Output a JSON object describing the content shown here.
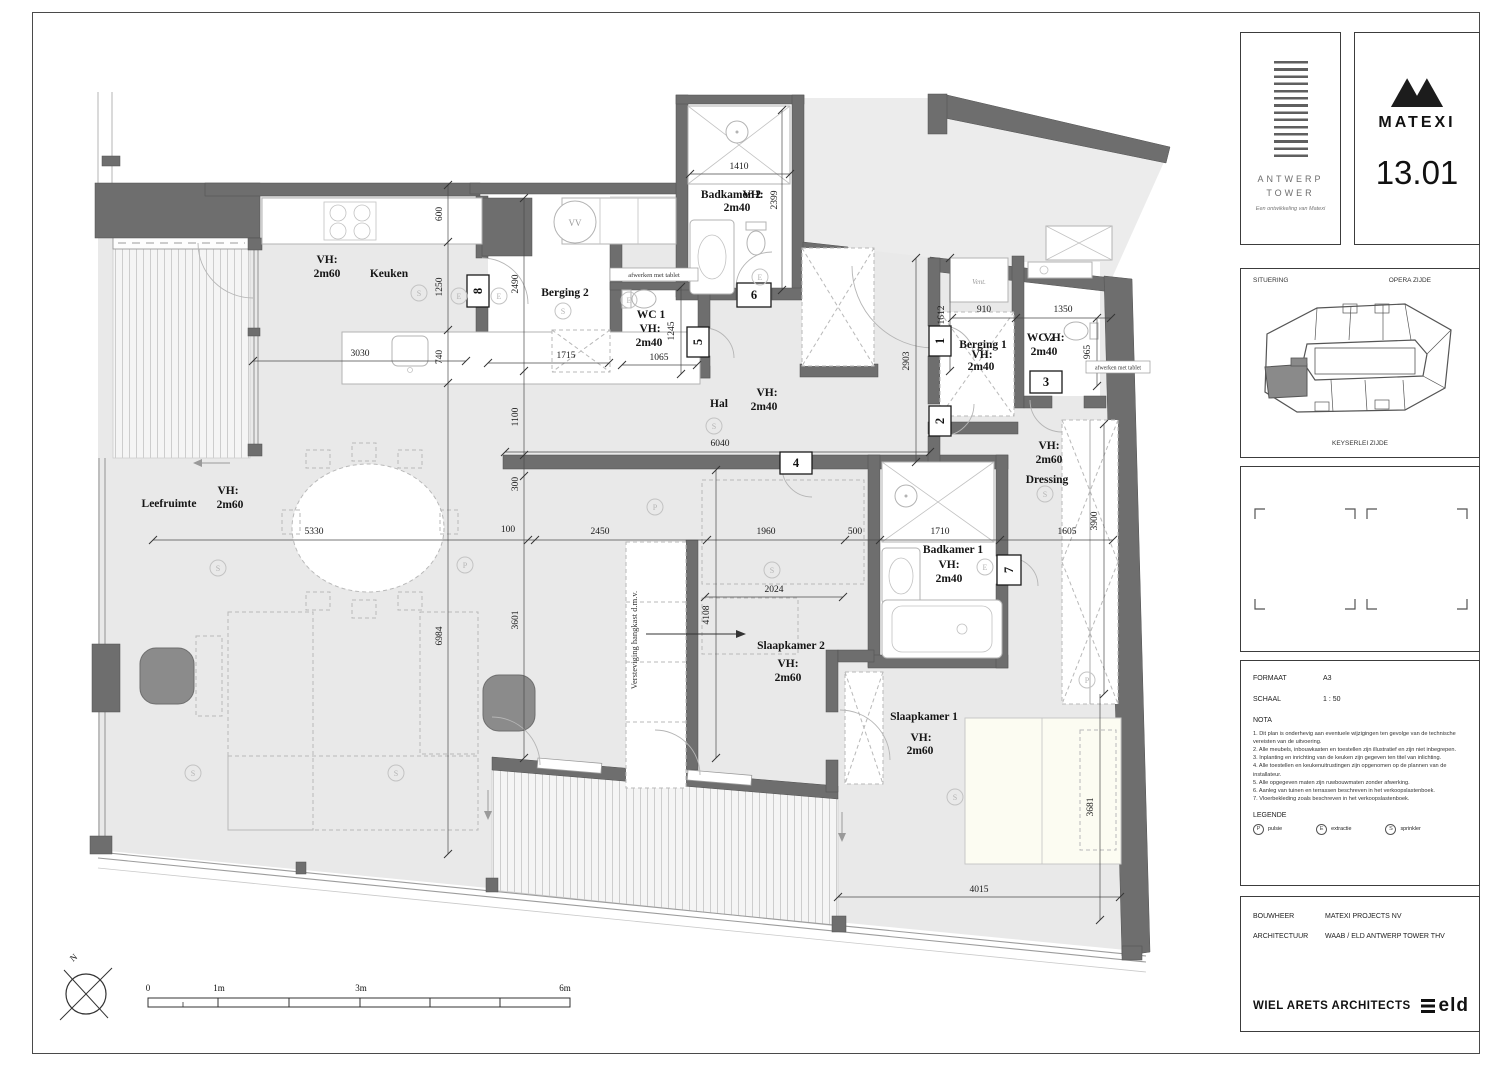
{
  "sheet": {
    "panels": {
      "antwerp": {
        "title_line1": "ANTWERP",
        "title_line2": "TOWER",
        "tagline": "Een ontwikkeling van Matexi"
      },
      "matexi": {
        "brand": "MATEXI",
        "unit": "13.01"
      },
      "situering": {
        "label": "SITUERING",
        "top": "OPERA ZIJDE",
        "bottom": "KEYSERLEI ZIJDE"
      },
      "info": {
        "formaat_label": "FORMAAT",
        "formaat": "A3",
        "schaal_label": "SCHAAL",
        "schaal": "1 : 50",
        "nota_label": "NOTA",
        "nota": [
          "1. Dit plan is onderhevig aan eventuele wijzigingen ten gevolge van de technische vereisten van de uitvoering.",
          "2. Alle meubels, inbouwkasten en toestellen zijn illustratief en zijn niet inbegrepen.",
          "3. Inplanting en inrichting van de keuken zijn gegeven ten titel van inlichting.",
          "4. Alle toestellen en keukenuitrustingen zijn opgenomen op de plannen van de installateur.",
          "5. Alle opgegeven maten zijn ruwbouwmaten zonder afwerking.",
          "6. Aanleg van tuinen en terrassen beschreven in het verkoopslastenboek.",
          "7. Vloerbekleding zoals beschreven in het verkoopslastenboek."
        ],
        "legende_label": "LEGENDE",
        "legende": [
          {
            "sym": "P",
            "label": "pulsie"
          },
          {
            "sym": "E",
            "label": "extractie"
          },
          {
            "sym": "S",
            "label": "sprinkler"
          }
        ]
      },
      "credits": {
        "bouwheer_label": "BOUWHEER",
        "bouwheer": "MATEXI PROJECTS NV",
        "architectuur_label": "ARCHITECTUUR",
        "architectuur": "WAAB / ELD ANTWERP TOWER THV",
        "architect": "WIEL ARETS ARCHITECTS",
        "partner": "eld"
      }
    }
  },
  "plan": {
    "rooms": {
      "leefruimte": {
        "name": "Leefruimte",
        "vh": "VH:",
        "h": "2m60"
      },
      "keuken": {
        "name": "Keuken",
        "vh": "VH:",
        "h": "2m60"
      },
      "berging2": {
        "name": "Berging 2"
      },
      "wc1": {
        "name": "WC 1",
        "vh": "VH:",
        "h": "2m40"
      },
      "badkamer2": {
        "name": "Badkamer 2",
        "vh": "VH:",
        "h": "2m40"
      },
      "hal": {
        "name": "Hal",
        "vh": "VH:",
        "h": "2m40"
      },
      "berging1": {
        "name": "Berging 1",
        "vh": "VH:",
        "h": "2m40"
      },
      "wc2": {
        "name": "WC 2",
        "vh": "VH:",
        "h": "2m40"
      },
      "dressing": {
        "name": "Dressing",
        "vh": "VH:",
        "h": "2m60"
      },
      "badkamer1": {
        "name": "Badkamer 1",
        "vh": "VH:",
        "h": "2m40"
      },
      "slaapkamer2": {
        "name": "Slaapkamer 2",
        "vh": "VH:",
        "h": "2m60"
      },
      "slaapkamer1": {
        "name": "Slaapkamer 1",
        "vh": "VH:",
        "h": "2m60"
      }
    },
    "dims": {
      "d1410": "1410",
      "d2399": "2399",
      "d600": "600",
      "d1250": "1250",
      "d740": "740",
      "d3030": "3030",
      "d2490": "2490",
      "d1715": "1715",
      "d1245": "1245",
      "d1065": "1065",
      "d1100": "1100",
      "d300": "300",
      "d6040": "6040",
      "d1612": "1612",
      "d910": "910",
      "d1350": "1350",
      "d965": "965",
      "d2903": "2903",
      "d3900": "3900",
      "d5330": "5330",
      "d100": "100",
      "d2450": "2450",
      "d1960": "1960",
      "d500": "500",
      "d1710": "1710",
      "d1605": "1605",
      "d2024": "2024",
      "d4108": "4108",
      "d3601": "3601",
      "d6984": "6984",
      "d3681": "3681",
      "d4015": "4015"
    },
    "doors": {
      "n1": "1",
      "n2": "2",
      "n3": "3",
      "n4": "4",
      "n5": "5",
      "n6": "6",
      "n7": "7",
      "n8": "8"
    },
    "notes": {
      "afwerken": "afwerken met tablet",
      "versteviging": "Versteviging hangkast d.m.v.",
      "vent": "Vent.",
      "vv": "VV"
    },
    "symbols": {
      "p": "P",
      "e": "E",
      "s": "S"
    },
    "scalebar": {
      "t0": "0",
      "t1": "1m",
      "t3": "3m",
      "t6": "6m"
    },
    "north": "N"
  }
}
